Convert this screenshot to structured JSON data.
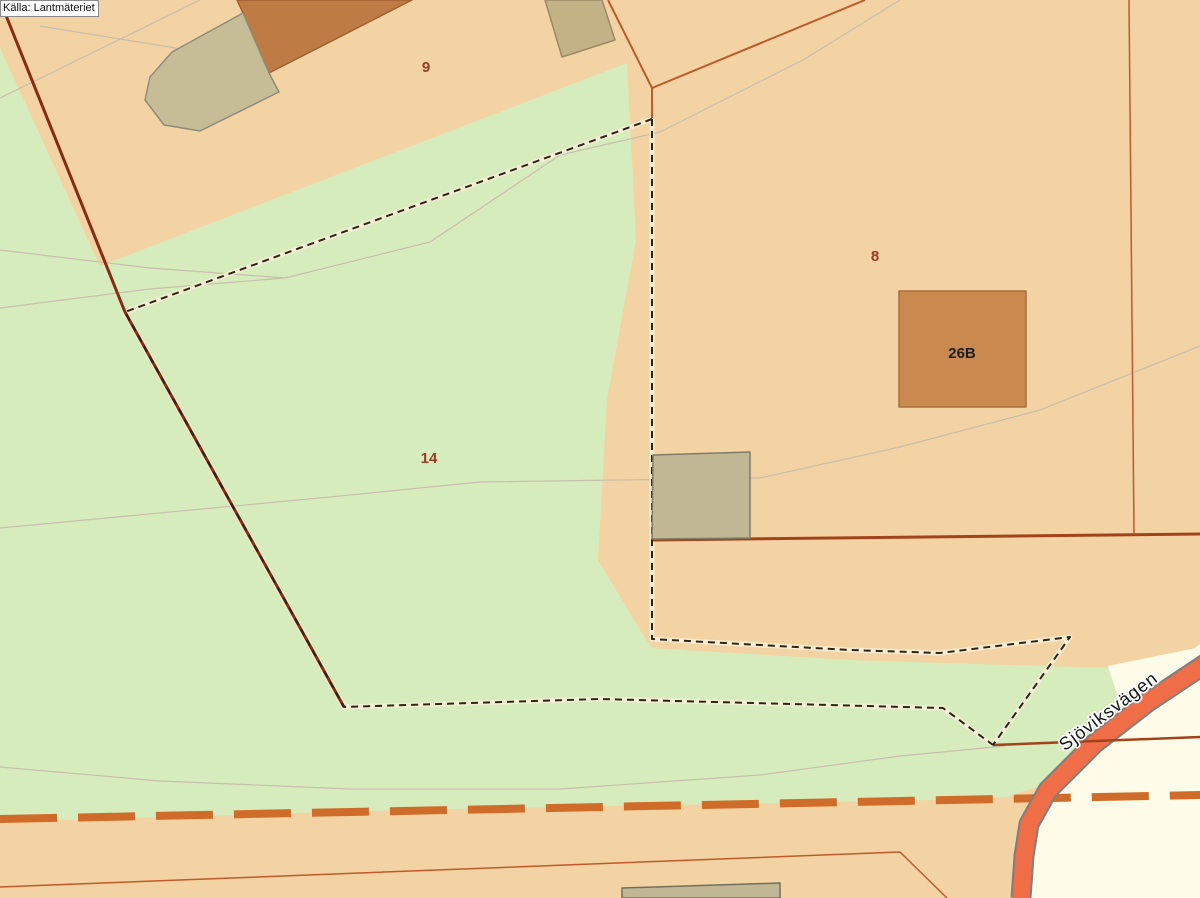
{
  "source_label": "Källa: Lantmäteriet",
  "colors": {
    "land_parcel": "#f3d3a3",
    "vegetation_green": "#d6ecbc",
    "road_corridor_white": "#fefce8",
    "road_fill": "#ef6d47",
    "road_casing": "#7f7f7f",
    "boundary_red": "#8a2a12",
    "boundary_orange": "#bf5a2a",
    "boundary_dark_orange": "#a1431b",
    "orange_dash": "#d06c2a",
    "cadastral_dash_black": "#2e2414",
    "contour_gray": "#c8beac",
    "parcel_label_red": "#9c3a26",
    "building_label_black": "#1f1f1f",
    "building_brown": "#bf7b44",
    "building_khaki": "#c2b794"
  },
  "canvas": {
    "w": 1200,
    "h": 898,
    "bg": "#f3d3a3"
  },
  "layers": [
    {
      "name": "vegetation-area",
      "kind": "polygon",
      "fill": "#d6ecbc",
      "points": [
        [
          0,
          48
        ],
        [
          100,
          266
        ],
        [
          627,
          63
        ],
        [
          636,
          240
        ],
        [
          607,
          400
        ],
        [
          598,
          560
        ],
        [
          645,
          638
        ],
        [
          652,
          648
        ],
        [
          850,
          660
        ],
        [
          1043,
          666
        ],
        [
          1113,
          668
        ],
        [
          1160,
          680
        ],
        [
          1125,
          702
        ],
        [
          1085,
          742
        ],
        [
          1050,
          782
        ],
        [
          1008,
          797
        ],
        [
          935,
          800
        ],
        [
          400,
          810
        ],
        [
          0,
          822
        ]
      ]
    },
    {
      "name": "road-corridor-white-area",
      "kind": "polygon",
      "fill": "#fefce8",
      "points": [
        [
          1200,
          644
        ],
        [
          1150,
          684
        ],
        [
          1100,
          726
        ],
        [
          1060,
          772
        ],
        [
          1036,
          812
        ],
        [
          1024,
          860
        ],
        [
          1020,
          898
        ],
        [
          1200,
          898
        ]
      ]
    },
    {
      "name": "road-corridor-white-wedge",
      "kind": "polygon",
      "fill": "#fefce8",
      "points": [
        [
          1108,
          666
        ],
        [
          1196,
          648
        ],
        [
          1200,
          662
        ],
        [
          1160,
          683
        ],
        [
          1120,
          703
        ]
      ]
    },
    {
      "name": "contour-line-a",
      "kind": "polyline",
      "stroke": "#c8beac",
      "width": 1.2,
      "points": [
        [
          0,
          98
        ],
        [
          200,
          0
        ]
      ]
    },
    {
      "name": "contour-line-b",
      "kind": "polyline",
      "stroke": "#c8beac",
      "width": 1.2,
      "points": [
        [
          40,
          26
        ],
        [
          200,
          52
        ]
      ]
    },
    {
      "name": "contour-line-c",
      "kind": "polyline",
      "stroke": "#c8beac",
      "width": 1.2,
      "points": [
        [
          0,
          250
        ],
        [
          150,
          268
        ],
        [
          285,
          278
        ],
        [
          430,
          242
        ],
        [
          560,
          155
        ],
        [
          660,
          132
        ],
        [
          803,
          60
        ],
        [
          900,
          0
        ]
      ]
    },
    {
      "name": "contour-line-c2",
      "kind": "polyline",
      "stroke": "#c8beac",
      "width": 1.2,
      "points": [
        [
          0,
          308
        ],
        [
          150,
          289
        ],
        [
          285,
          278
        ]
      ]
    },
    {
      "name": "contour-line-d",
      "kind": "polyline",
      "stroke": "#c8beac",
      "width": 1.2,
      "points": [
        [
          0,
          528
        ],
        [
          330,
          497
        ],
        [
          480,
          482
        ],
        [
          760,
          478
        ],
        [
          900,
          447
        ],
        [
          1040,
          410
        ],
        [
          1200,
          346
        ]
      ]
    },
    {
      "name": "contour-line-e",
      "kind": "polyline",
      "stroke": "#c8beac",
      "width": 1.2,
      "points": [
        [
          0,
          767
        ],
        [
          160,
          781
        ],
        [
          350,
          789
        ],
        [
          560,
          789
        ],
        [
          760,
          775
        ],
        [
          900,
          756
        ],
        [
          1005,
          746
        ]
      ]
    },
    {
      "name": "boundary-orange-dashed",
      "kind": "polyline",
      "stroke": "#d06c2a",
      "width": 8,
      "dash": "57 21",
      "points": [
        [
          0,
          819
        ],
        [
          1200,
          795
        ]
      ]
    },
    {
      "name": "road-casing",
      "kind": "polyline",
      "stroke": "#7f7f7f",
      "width": 21,
      "points": [
        [
          1208,
          662
        ],
        [
          1148,
          702
        ],
        [
          1094,
          744
        ],
        [
          1048,
          790
        ],
        [
          1029,
          824
        ],
        [
          1024,
          856
        ],
        [
          1021,
          898
        ]
      ]
    },
    {
      "name": "road-fill",
      "kind": "polyline",
      "stroke": "#ef6d47",
      "width": 17,
      "points": [
        [
          1210,
          661
        ],
        [
          1148,
          702
        ],
        [
          1094,
          744
        ],
        [
          1048,
          790
        ],
        [
          1029,
          824
        ],
        [
          1024,
          856
        ],
        [
          1021,
          900
        ]
      ]
    },
    {
      "name": "cadastral-dash-halo-1",
      "kind": "polyline",
      "stroke": "#f7eed9",
      "width": 5,
      "opacity": 0.85,
      "points": [
        [
          652,
          119
        ],
        [
          125,
          312
        ],
        [
          344,
          707
        ],
        [
          600,
          699
        ],
        [
          943,
          708
        ],
        [
          993,
          745
        ]
      ]
    },
    {
      "name": "cadastral-dash-halo-2",
      "kind": "polyline",
      "stroke": "#f7eed9",
      "width": 5,
      "opacity": 0.85,
      "points": [
        [
          652,
          119
        ],
        [
          652,
          639
        ],
        [
          850,
          650
        ],
        [
          940,
          653
        ],
        [
          1070,
          637
        ],
        [
          993,
          745
        ]
      ]
    },
    {
      "name": "municipal-boundary-red-line",
      "kind": "polyline",
      "stroke": "#8a2a12",
      "width": 3,
      "points": [
        [
          3,
          8
        ],
        [
          125,
          312
        ],
        [
          344,
          707
        ]
      ]
    },
    {
      "name": "parcel-boundary-top",
      "kind": "path",
      "stroke": "#bf5a2a",
      "width": 2,
      "d": "M608,0 L652,88 L865,0 M652,88 L652,118"
    },
    {
      "name": "parcel-boundary-vertical",
      "kind": "polyline",
      "stroke": "#bf5a2a",
      "width": 1.5,
      "points": [
        [
          1129,
          0
        ],
        [
          1134,
          533
        ]
      ]
    },
    {
      "name": "parcel-boundary-horizontal",
      "kind": "polyline",
      "stroke": "#a1431b",
      "width": 3,
      "points": [
        [
          652,
          540
        ],
        [
          1200,
          534
        ]
      ]
    },
    {
      "name": "parcel-boundary-lower-horizontal",
      "kind": "polyline",
      "stroke": "#a1431b",
      "width": 2.5,
      "points": [
        [
          993,
          745
        ],
        [
          1200,
          737
        ]
      ]
    },
    {
      "name": "parcel-boundary-bottom-thin",
      "kind": "polyline",
      "stroke": "#bf5a2a",
      "width": 1.5,
      "points": [
        [
          0,
          887
        ],
        [
          900,
          852
        ],
        [
          947,
          898
        ]
      ]
    },
    {
      "name": "cadastral-dashed-boundary-1",
      "kind": "polyline",
      "stroke": "#2e2414",
      "width": 2,
      "dash": "7 5",
      "points": [
        [
          652,
          119
        ],
        [
          125,
          312
        ],
        [
          344,
          707
        ],
        [
          600,
          699
        ],
        [
          943,
          708
        ],
        [
          993,
          745
        ]
      ]
    },
    {
      "name": "cadastral-dashed-boundary-2",
      "kind": "polyline",
      "stroke": "#2e2414",
      "width": 2,
      "dash": "7 5",
      "points": [
        [
          652,
          119
        ],
        [
          652,
          639
        ],
        [
          850,
          650
        ],
        [
          940,
          653
        ],
        [
          1070,
          637
        ],
        [
          993,
          745
        ]
      ]
    },
    {
      "name": "building-brown-top-left",
      "kind": "polygon",
      "fill": "#bf7b44",
      "stroke": "#a2602f",
      "width": 1.5,
      "points": [
        [
          237,
          0
        ],
        [
          412,
          0
        ],
        [
          269,
          73
        ],
        [
          243,
          13
        ]
      ]
    },
    {
      "name": "building-khaki-top-left",
      "kind": "polygon",
      "fill": "#c6bc96",
      "stroke": "#8f8d79",
      "width": 1.5,
      "points": [
        [
          243,
          13
        ],
        [
          269,
          73
        ],
        [
          279,
          92
        ],
        [
          200,
          131
        ],
        [
          164,
          125
        ],
        [
          145,
          100
        ],
        [
          150,
          77
        ],
        [
          172,
          52
        ]
      ]
    },
    {
      "name": "building-khaki-top-center",
      "kind": "polygon",
      "fill": "#c4b287",
      "stroke": "#998a65",
      "width": 1.5,
      "points": [
        [
          545,
          0
        ],
        [
          602,
          0
        ],
        [
          615,
          40
        ],
        [
          562,
          57
        ]
      ]
    },
    {
      "name": "building-khaki-middle",
      "kind": "polygon",
      "fill": "#c2b794",
      "stroke": "#7e7d6a",
      "width": 1.5,
      "points": [
        [
          653,
          455
        ],
        [
          750,
          452
        ],
        [
          750,
          538
        ],
        [
          652,
          539
        ]
      ]
    },
    {
      "name": "building-khaki-bottom",
      "kind": "polygon",
      "fill": "#c2b794",
      "stroke": "#70705e",
      "width": 1.5,
      "points": [
        [
          622,
          888
        ],
        [
          780,
          883
        ],
        [
          780,
          898
        ],
        [
          622,
          898
        ]
      ]
    },
    {
      "name": "building-26b",
      "kind": "polygon",
      "fill": "#c9894f",
      "stroke": "#a8713c",
      "width": 1.5,
      "points": [
        [
          899,
          291
        ],
        [
          1026,
          291
        ],
        [
          1026,
          407
        ],
        [
          899,
          407
        ]
      ]
    },
    {
      "name": "parcel-label-9",
      "kind": "text",
      "text": "9",
      "x": 426,
      "y": 72,
      "fill": "#9c3a26",
      "size": 15,
      "weight": "bold"
    },
    {
      "name": "parcel-label-8",
      "kind": "text",
      "text": "8",
      "x": 875,
      "y": 261,
      "fill": "#9c3a26",
      "size": 15,
      "weight": "bold"
    },
    {
      "name": "parcel-label-14",
      "kind": "text",
      "text": "14",
      "x": 429,
      "y": 463,
      "fill": "#9c3a26",
      "size": 15,
      "weight": "bold"
    },
    {
      "name": "building-label-26b",
      "kind": "text",
      "text": "26B",
      "x": 962,
      "y": 358,
      "fill": "#1f1f1f",
      "size": 15,
      "weight": "bold"
    },
    {
      "name": "road-label-sjoviksvagen",
      "kind": "text",
      "text": "Sjöviksvägen",
      "x": 1112,
      "y": 716,
      "fill": "#141414",
      "size": 18,
      "weight": "normal",
      "rotate": -37,
      "halo": "#ffffff",
      "spacing": 1
    }
  ]
}
